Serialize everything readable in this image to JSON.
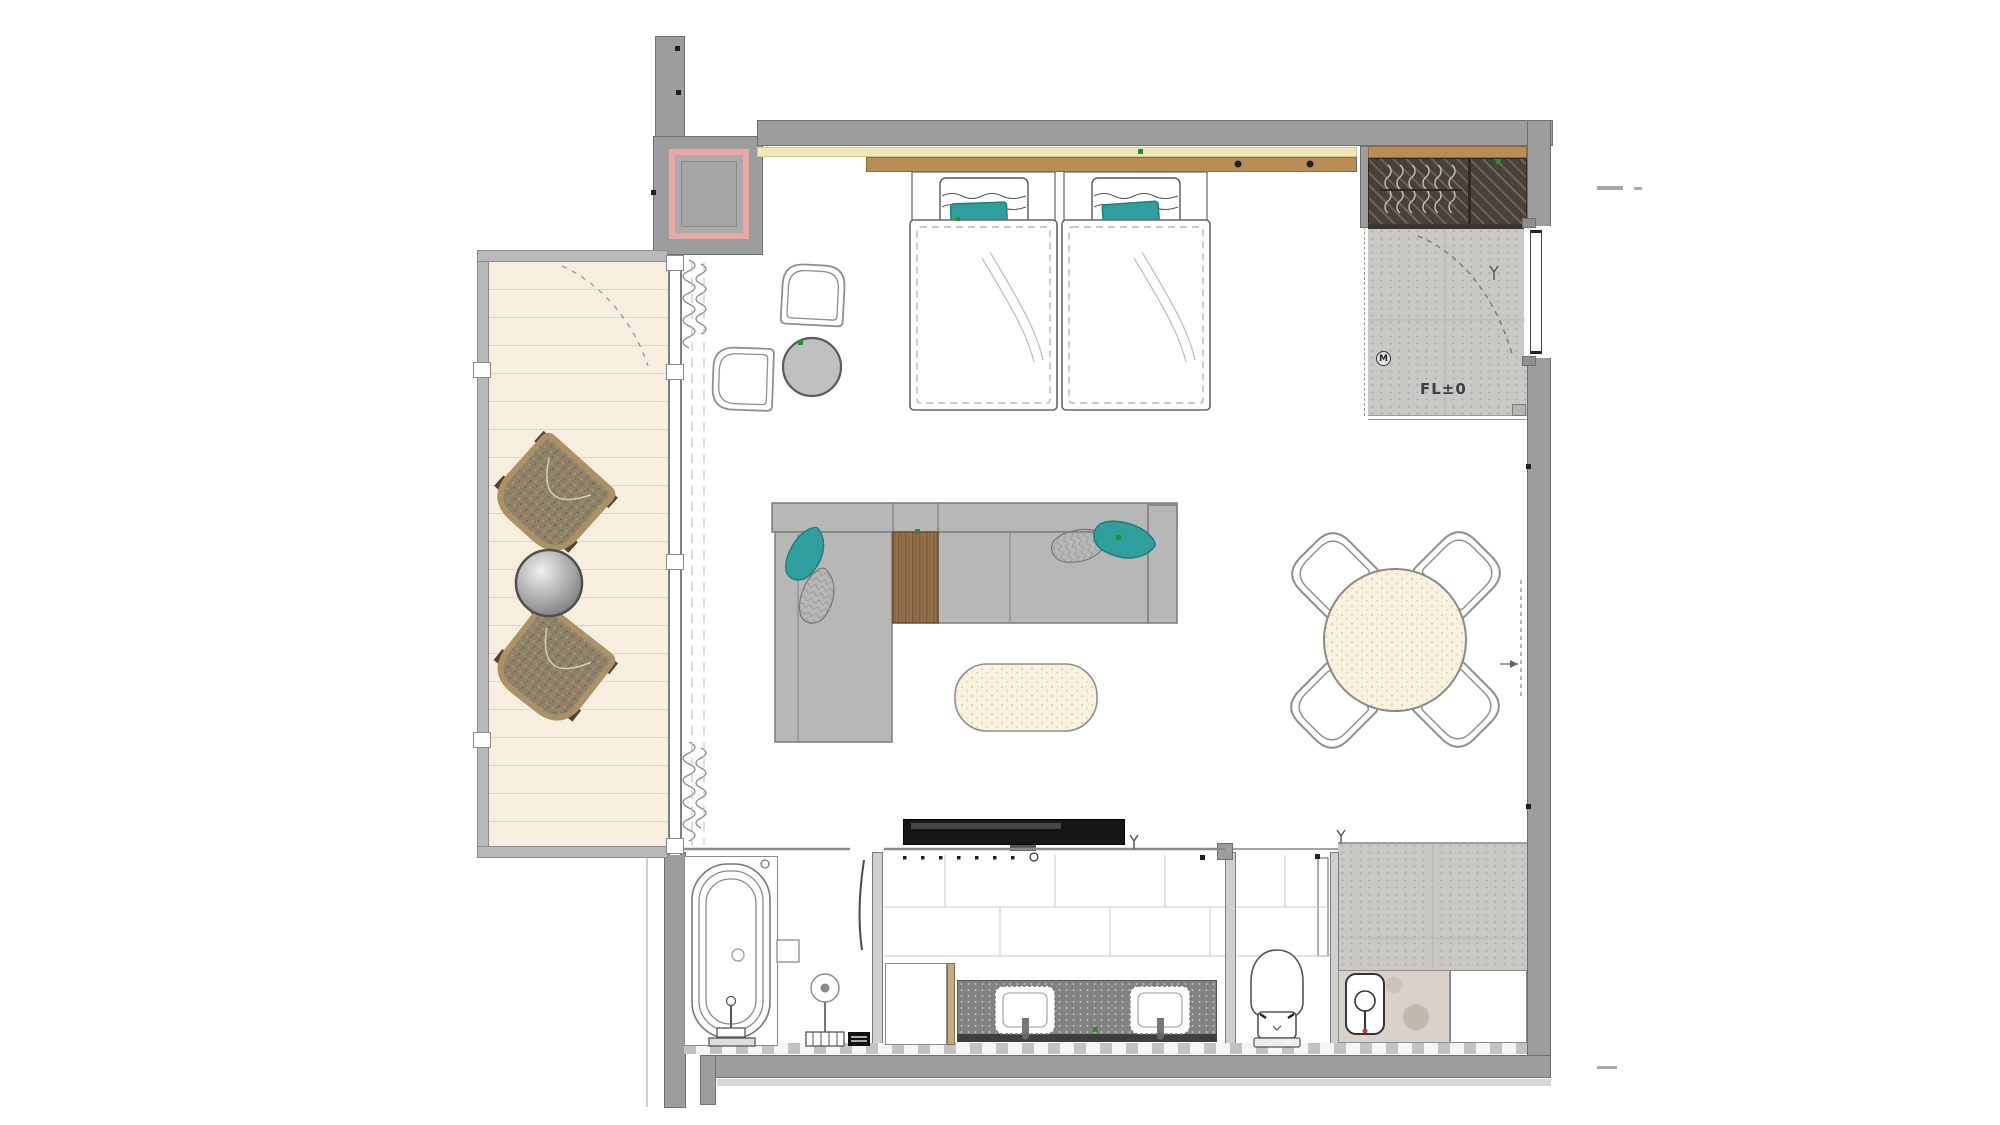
{
  "annotations": {
    "floor_level": "FL±0",
    "meter_mark": "M"
  },
  "colors": {
    "wall": "#9d9d9d",
    "wall_outline": "#6f6f6f",
    "accent_teal": "#2f9e9c",
    "balcony_deck": "#f7eee0",
    "entry_floor": "#c9c8c4",
    "closet_interior": "#48413a",
    "headboard_wood": "#b98d57",
    "cove_light": "#efe9b8",
    "shaft_pink": "#e8a8a6",
    "upholstery_gray": "#b7b7b7",
    "cream_speckle": "#f8f2df",
    "vanity_counter": "#828282",
    "tv_black": "#161616",
    "green_marker": "#2e8b2e"
  }
}
